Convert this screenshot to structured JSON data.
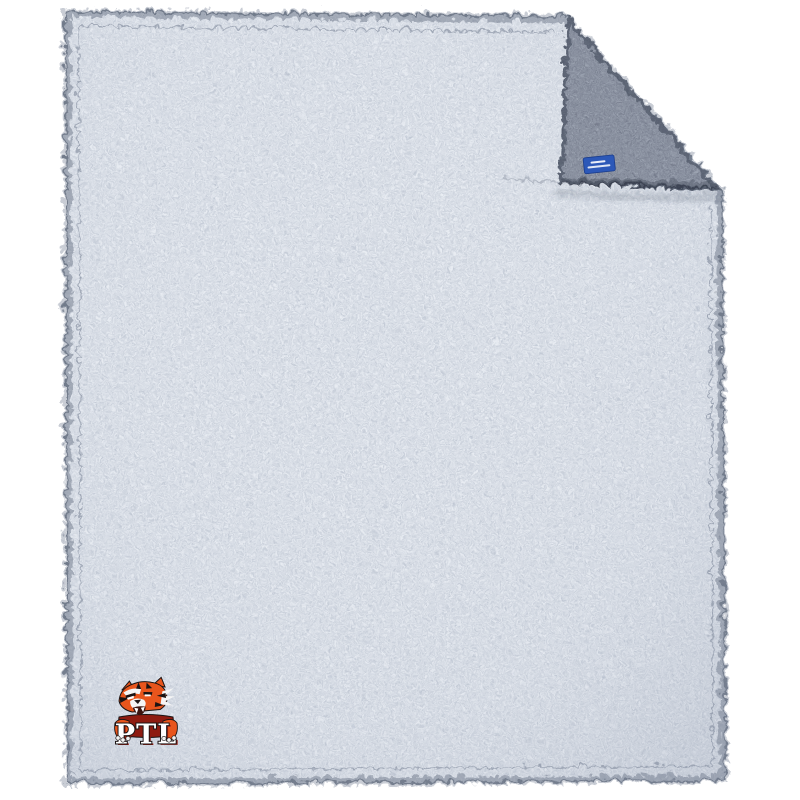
{
  "page": {
    "background_color": "#ffffff"
  },
  "product_image": {
    "description": "Frosty gray sherpa fleece blanket, top-right corner folded over showing darker reverse side, woven blue tag at fold hem, embroidered tiger mascot logo at lower left",
    "blanket": {
      "front_color": "#e9edf3",
      "fleck_color": "#6b7890",
      "underside_color": "#a3abb8",
      "underside_fleck_color": "#2e3542",
      "edge_color": "#6c7688"
    },
    "fold_tag": {
      "fill_color": "#2c58b8",
      "border_color": "#1c3d8a",
      "text_color": "#ffffff"
    },
    "logo": {
      "text": "PTL",
      "mascot": "tiger",
      "orange": "#e8551c",
      "dark_orange": "#b93a12",
      "banner_color": "#8e1b10",
      "outline_color": "#1a1313",
      "letter_color": "#ffffff",
      "white": "#f5f5f5"
    }
  }
}
